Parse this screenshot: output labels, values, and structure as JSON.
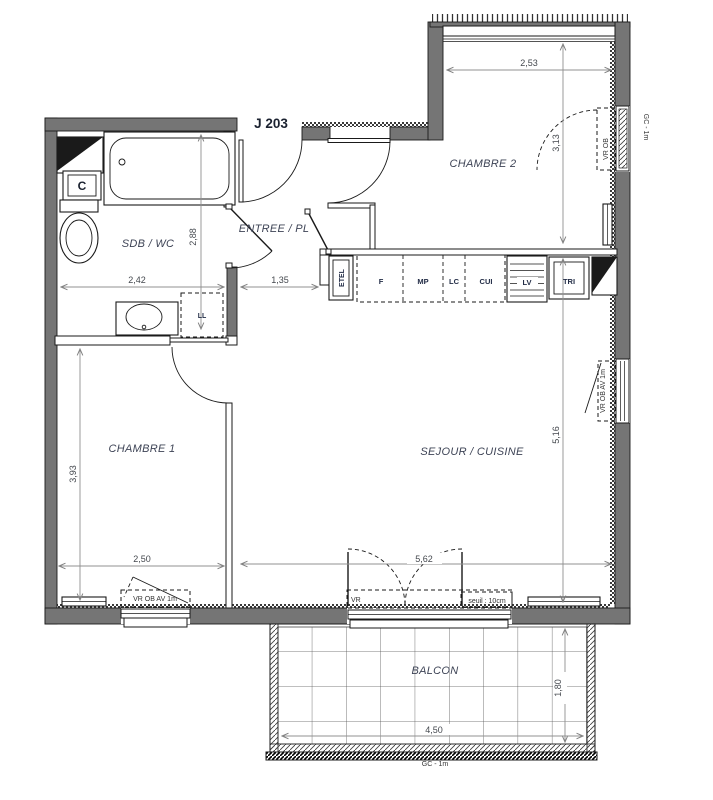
{
  "title": "J 203",
  "rooms": {
    "chambre2": "CHAMBRE 2",
    "sdb": "SDB / WC",
    "entree": "ENTREE / PL",
    "chambre1": "CHAMBRE 1",
    "sejour": "SEJOUR / CUISINE",
    "balcon": "BALCON"
  },
  "dims": {
    "ch2_w": "2,53",
    "ch2_h": "3,13",
    "sdb_w": "2,42",
    "sdb_h": "2,88",
    "entree_w": "1,35",
    "ch1_h": "3,93",
    "ch1_w": "2,50",
    "sej_w": "5,62",
    "sej_h": "5,16",
    "balcon_w": "4,50",
    "balcon_d": "1,80"
  },
  "openings": {
    "ch2_window": "VR  OB",
    "gc_right": "GC - 1m",
    "sej_window": "VR  OB  AV 1m",
    "ch1_window": "VR  OB  AV 1m",
    "sej_door": "VR",
    "seuil": "seuil : 10cm",
    "gc_balcony": "GC - 1m"
  },
  "equipment": {
    "c": "C",
    "ll": "LL",
    "etel": "ETEL",
    "kitchen": {
      "f": "F",
      "mp": "MP",
      "lc": "LC",
      "cui": "CUI",
      "lv": "LV",
      "tri": "TRI"
    }
  },
  "colors": {
    "wall": "#757575",
    "line": "#1a1a1a",
    "dim_line": "#909090",
    "dim_text": "#44484e",
    "room_label": "#3e4456",
    "title": "#1b2230"
  }
}
